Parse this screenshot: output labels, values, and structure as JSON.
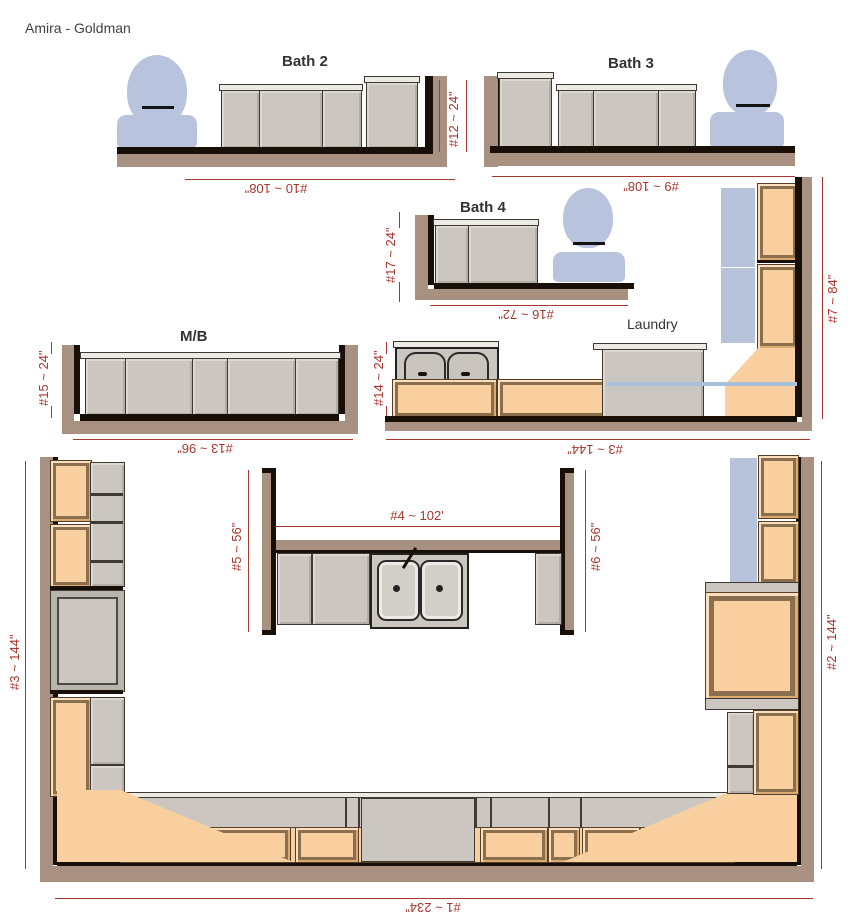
{
  "title": "Amira - Goldman",
  "rooms": {
    "bath2": "Bath 2",
    "bath3": "Bath 3",
    "bath4": "Bath 4",
    "master_bath": "M/B",
    "laundry": "Laundry"
  },
  "dimensions": {
    "d1": "#1 ~ 234\"",
    "d2": "#2 ~ 144\"",
    "d3_kitchen_left": "#3 ~ 144\"",
    "d3_laundry": "#3 ~ 144\"",
    "d4": "#4 ~ 102'",
    "d5": "#5 ~ 56\"",
    "d6": "#6 ~ 56\"",
    "d7": "#7 ~ 84\"",
    "d9": "#9 ~ 108\"",
    "d10": "#10 ~ 108\"",
    "d12": "#12 ~ 24\"",
    "d13": "#13 ~ 96\"",
    "d14": "#14 ~ 24\"",
    "d15": "#15 ~ 24\"",
    "d16": "#16 ~ 72\"",
    "d17": "#17 ~ 24\""
  },
  "colors": {
    "dimension_red": "#a8372e",
    "wall_tan": "#a89181",
    "cabinet_gray": "#cbc7c0",
    "cabinet_orange": "#f9cf9f",
    "fixture_blue": "#b8c3dd",
    "outline_dark": "#181008"
  }
}
